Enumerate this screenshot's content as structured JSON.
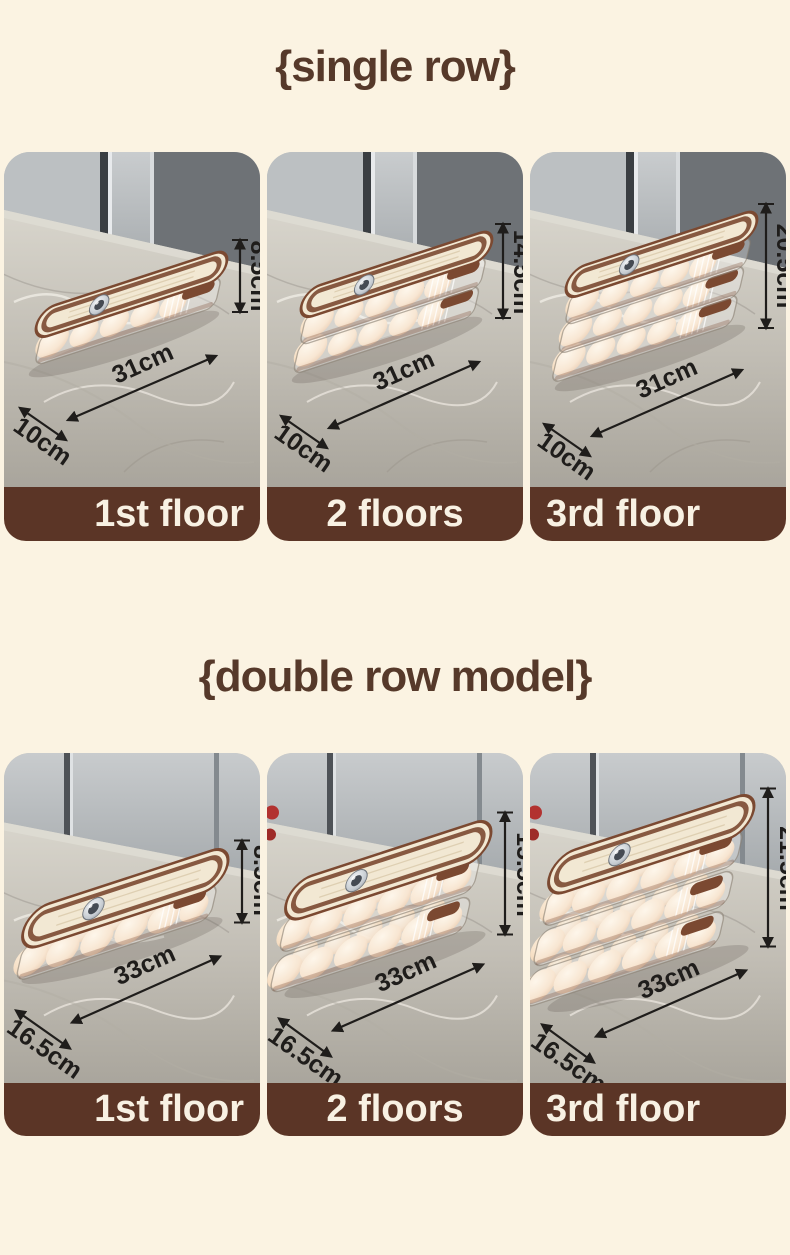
{
  "page": {
    "background": "#FBF3E2"
  },
  "colors": {
    "title_text": "#56392A",
    "bar_background": "#5B3526",
    "bar_text": "#F8F1E3",
    "annotation_text": "#1F1D1B",
    "lid_cream": "#F2E8D3",
    "trim_brown": "#7B4931",
    "egg": "#F5DCC0",
    "marble": "#C2BEB5",
    "cabinet_gray": "#AAAEB1"
  },
  "sections": [
    {
      "id": "single-row",
      "title": "{single row}",
      "items": [
        {
          "label": "1st floor",
          "floors": 1,
          "height": "8.5cm",
          "length": "31cm",
          "width": "10cm"
        },
        {
          "label": "2 floors",
          "floors": 2,
          "height": "14.5cm",
          "length": "31cm",
          "width": "10cm"
        },
        {
          "label": "3rd floor",
          "floors": 3,
          "height": "20.5cm",
          "length": "31cm",
          "width": "10cm"
        }
      ]
    },
    {
      "id": "double-row",
      "title": "{double row model}",
      "items": [
        {
          "label": "1st floor",
          "floors": 1,
          "height": "8.5cm",
          "length": "33cm",
          "width": "16.5cm"
        },
        {
          "label": "2 floors",
          "floors": 2,
          "height": "15.5cm",
          "length": "33cm",
          "width": "16.5cm"
        },
        {
          "label": "3rd floor",
          "floors": 3,
          "height": "21.5cm",
          "length": "33cm",
          "width": "16.5cm"
        }
      ]
    }
  ]
}
